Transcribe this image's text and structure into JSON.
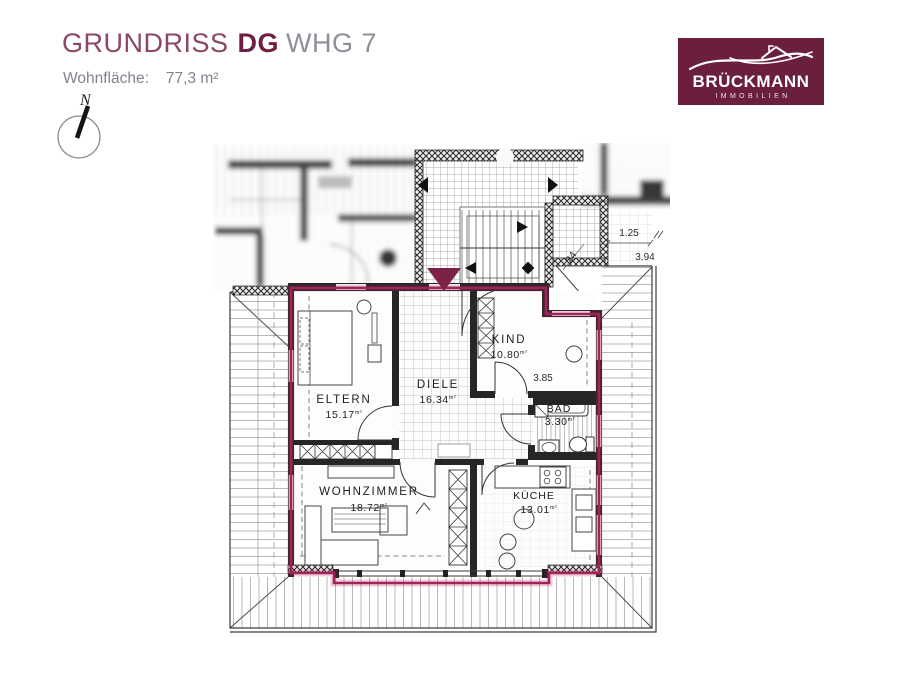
{
  "header": {
    "title": {
      "part1": "GRUNDRISS",
      "part2": "DG",
      "part3": "WHG 7"
    },
    "subtitle": {
      "label": "Wohnfläche:",
      "value": "77,3 m²"
    }
  },
  "logo": {
    "brand": "BRÜCKMANN",
    "tagline": "IMMOBILIEN"
  },
  "compass": {
    "north_label": "N"
  },
  "floorplan": {
    "rooms": [
      {
        "id": "eltern",
        "name": "ELTERN",
        "area": "15.17",
        "unit": "m²"
      },
      {
        "id": "diele",
        "name": "DIELE",
        "area": "16.34",
        "unit": "m²"
      },
      {
        "id": "kind",
        "name": "KIND",
        "area": "10.80",
        "unit": "m²"
      },
      {
        "id": "bad",
        "name": "BAD",
        "area": "3.30",
        "unit": "m²"
      },
      {
        "id": "wohnzimmer",
        "name": "WOHNZIMMER",
        "area": "18.72",
        "unit": "m²"
      },
      {
        "id": "kueche",
        "name": "KÜCHE",
        "area": "13.01",
        "unit": "m²"
      }
    ],
    "dimensions": {
      "d1": "1.25",
      "d2": "3.94",
      "d3": "3.85",
      "d4": "24"
    }
  },
  "colors": {
    "brand_maroon": "#6b1f3d",
    "boundary_maroon": "#a2225a",
    "title_maroon": "#8a4766",
    "title_bold_maroon": "#6e1f42",
    "muted_gray": "#8f8f99",
    "plan_line": "#262626"
  }
}
